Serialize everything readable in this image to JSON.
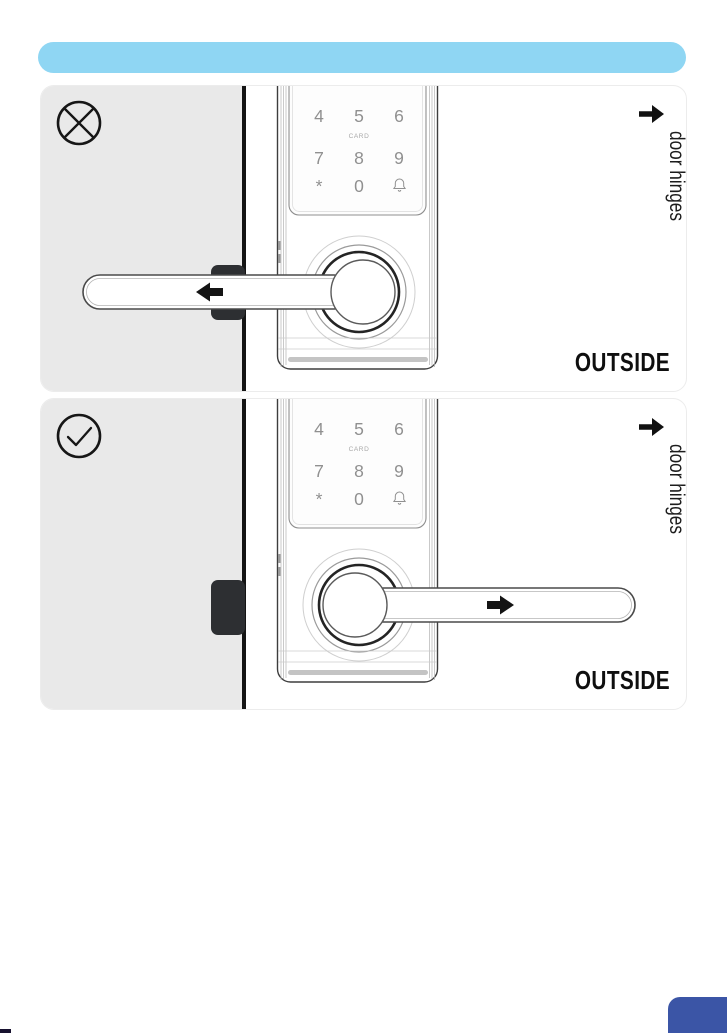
{
  "header": {
    "bar_color": "#8fd6f3"
  },
  "lock": {
    "keypad": {
      "row1": [
        "4",
        "5",
        "6"
      ],
      "card_label": "CARD",
      "row2": [
        "7",
        "8",
        "9"
      ],
      "star_key": "*",
      "zero_key": "0",
      "bell_icon": "doorbell-icon"
    }
  },
  "panels": [
    {
      "status": "incorrect",
      "status_icon": "cross-circle-icon",
      "handle_direction": "left",
      "hinge_arrow_icon": "right-arrow-icon",
      "hinge_label": "door hinges",
      "outside_label": "OUTSIDE"
    },
    {
      "status": "correct",
      "status_icon": "check-circle-icon",
      "handle_direction": "right",
      "hinge_arrow_icon": "right-arrow-icon",
      "hinge_label": "door hinges",
      "outside_label": "OUTSIDE"
    }
  ],
  "colors": {
    "header_bar": "#8fd6f3",
    "door_fill": "#e9e9e9",
    "door_edge": "#141414",
    "latch": "#2d2f32",
    "corner_accent": "#3b55a6",
    "footer_mark": "#17112f"
  }
}
